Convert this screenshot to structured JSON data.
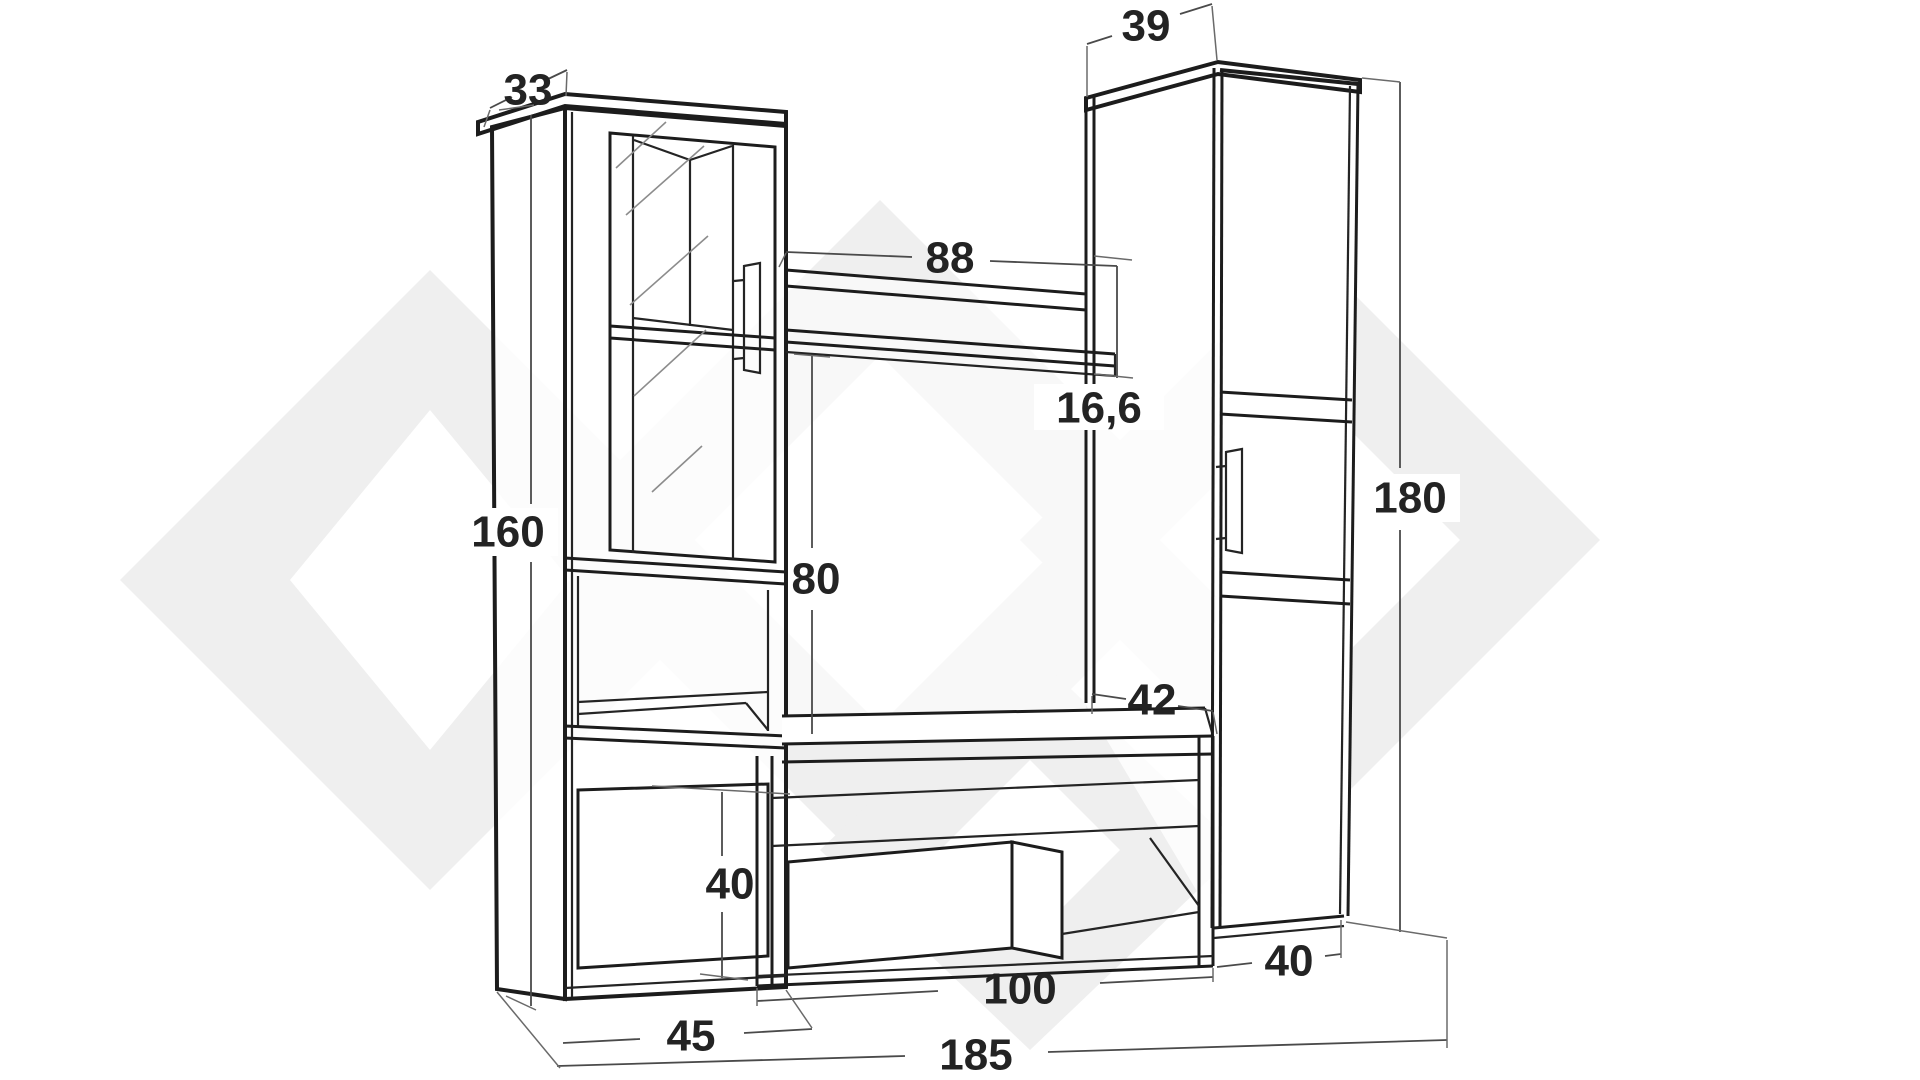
{
  "page": {
    "title": "Wall unit furniture dimensioned line drawing",
    "background_color": "#ffffff"
  },
  "diagram": {
    "kind": "furniture-dimension-drawing",
    "units_implied": "cm",
    "line_color": "#1c1c1c",
    "dimension_line_color": "#4a4a4a",
    "watermark_color": "#efefef",
    "parts": [
      "left-display-cabinet",
      "wall-panel-with-shelf",
      "tv-bench-with-drawer",
      "right-tall-cabinet"
    ],
    "dimensions": {
      "left_cabinet_top_depth": "33",
      "right_cabinet_top_depth": "39",
      "wall_shelf_width": "88",
      "shelf_offset": "16,6",
      "left_cabinet_height": "160",
      "panel_open_height": "80",
      "right_cabinet_height": "180",
      "bench_depth": "42",
      "left_base_door_height": "40",
      "tv_bench_width": "100",
      "right_bottom_width": "40",
      "left_cabinet_width": "45",
      "total_width": "185"
    }
  }
}
